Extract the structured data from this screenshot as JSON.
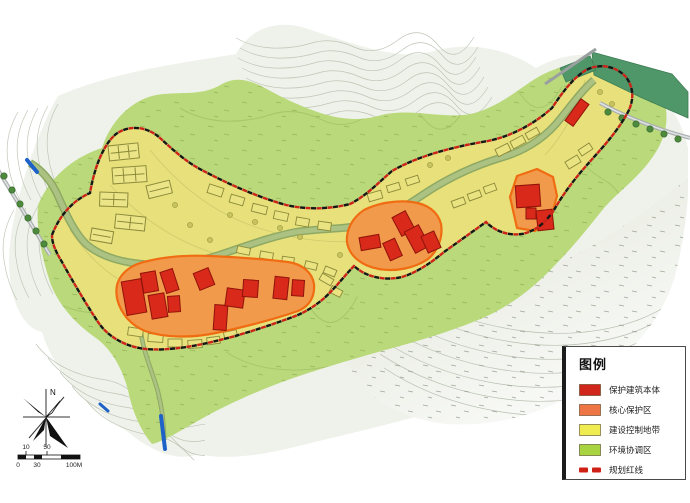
{
  "legend": {
    "title": "图例",
    "items": [
      {
        "label": "保护建筑本体",
        "color": "#d1261c",
        "type": "swatch"
      },
      {
        "label": "核心保护区",
        "color": "#ed7546",
        "type": "swatch"
      },
      {
        "label": "建设控制地带",
        "color": "#efec52",
        "type": "swatch"
      },
      {
        "label": "环境协调区",
        "color": "#a7d440",
        "type": "swatch"
      },
      {
        "label": "规划红线",
        "color": "#cf2016",
        "type": "dashes"
      }
    ]
  },
  "compass": {
    "north_label": "N"
  },
  "scale_bar": {
    "labels_top": [
      "10",
      "50"
    ],
    "labels_bottom": [
      "0",
      "30",
      "100M"
    ]
  },
  "map": {
    "colors": {
      "terrain_gray": "#eff2ea",
      "coordination_green": "#b9d97a",
      "control_zone_yellow": "#e7e07b",
      "core_zone_orange": "#f29a4b",
      "core_zone_border": "#f06c12",
      "building_red": "#d8291b",
      "building_red_border": "#8f1309",
      "reservoir_green": "#4f9768",
      "river_olive": "#abc283",
      "redline_red": "#cc2318",
      "redline_black": "#161616",
      "water_blue": "#1e62c8"
    }
  }
}
